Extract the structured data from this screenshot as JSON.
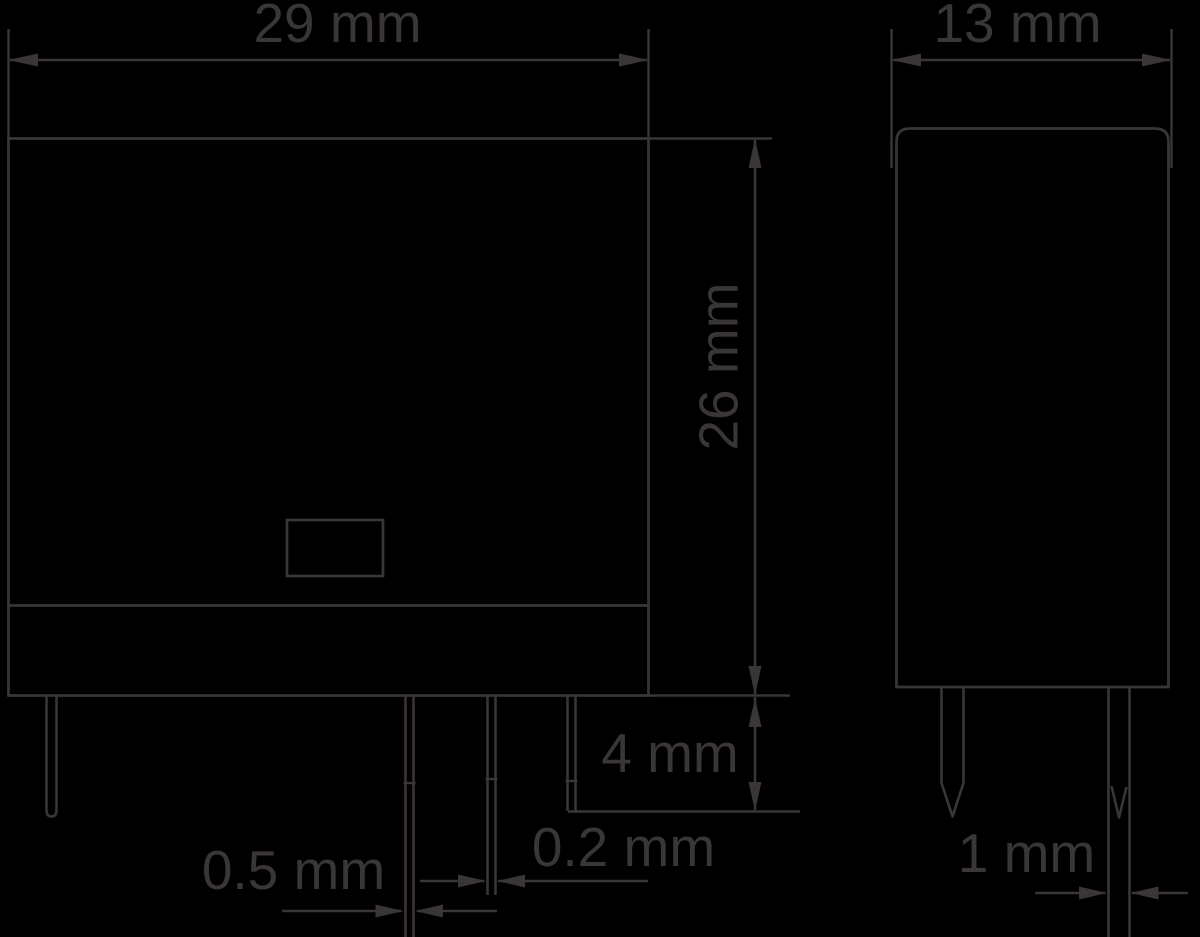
{
  "drawing": {
    "background_color": "#000000",
    "line_color": "#3a3536",
    "front_view": {
      "width_label": "29 mm",
      "height_label": "26 mm",
      "pin_protrusion_label": "4 mm",
      "pin_thickness_label": "0.5 mm",
      "pin_web_thickness_label": "0.2 mm"
    },
    "side_view": {
      "width_label": "13 mm",
      "pin_width_label": "1 mm"
    }
  }
}
